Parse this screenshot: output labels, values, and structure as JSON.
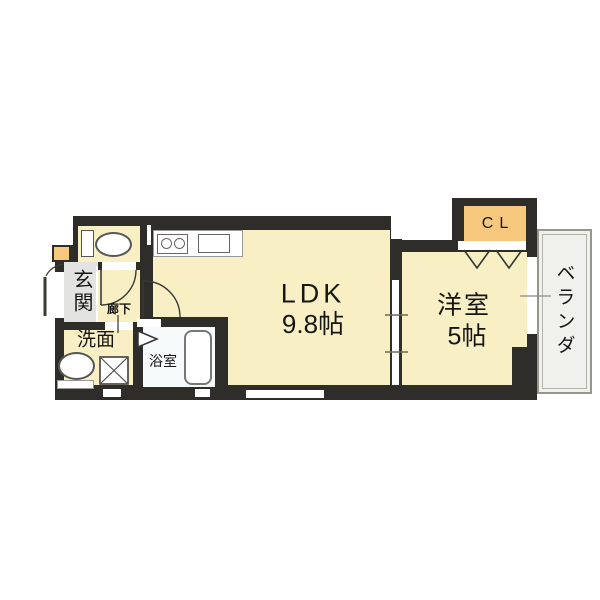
{
  "floorplan": {
    "title": "1LDK apartment floor plan",
    "rooms": {
      "ldk": {
        "name": "LDK",
        "size": "9.8帖"
      },
      "western_room": {
        "name": "洋室",
        "size": "5帖"
      },
      "closet": {
        "name": "CL"
      },
      "veranda": {
        "name": "ベランダ"
      },
      "entrance": {
        "name": "玄関"
      },
      "hallway": {
        "name": "廊下"
      },
      "washroom": {
        "name": "洗面"
      },
      "bathroom": {
        "name": "浴室"
      }
    },
    "fixtures": [
      "toilet-icon",
      "kitchen-stove-icon",
      "kitchen-sink-icon",
      "washbasin-icon",
      "washing-machine-icon",
      "bathtub-icon",
      "door-swing-icon",
      "sliding-door-icon",
      "folding-door-icon",
      "window-icon"
    ],
    "colors": {
      "wall": "#2e2d29",
      "room_fill": "#f9efc5",
      "closet_fill": "#f6c87d",
      "entrance_fill": "#e3e3e1",
      "bathroom_fill": "#f6fafa",
      "veranda_fill": "#f0f0ed",
      "background": "#ffffff"
    }
  }
}
